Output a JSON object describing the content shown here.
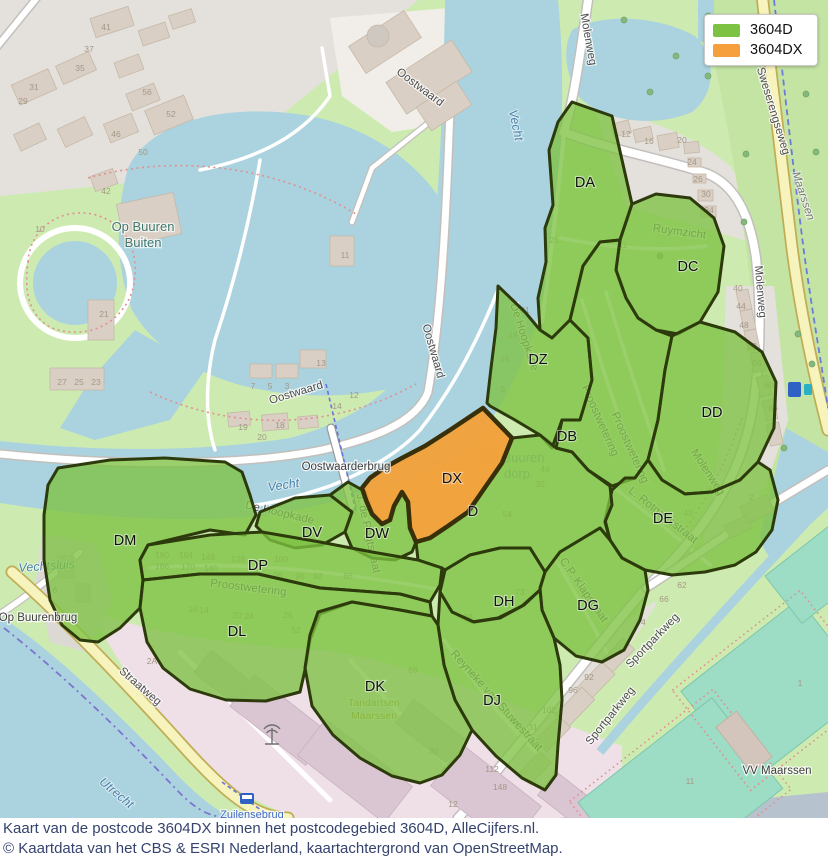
{
  "legend": {
    "items": [
      {
        "label": "3604D",
        "color": "#7dc243"
      },
      {
        "label": "3604DX",
        "color": "#f5a03c"
      }
    ]
  },
  "caption": {
    "line1": "Kaart van de postcode 3604DX binnen het postcodegebied 3604D, AlleCijfers.nl.",
    "line2": "© Kaartdata van het CBS & ESRI Nederland, kaartachtergrond van OpenStreetMap."
  },
  "colors": {
    "region_green": "#7dc243",
    "region_orange": "#f5a03c",
    "region_outline": "#2c3a0c",
    "water": "#aad3df",
    "grass": "#cdebb0",
    "residential": "#e4e1dd",
    "industrial": "#efdfe7",
    "pitch": "#9ddcc5",
    "road_yellow": "#f7f3bc"
  },
  "map": {
    "regions": [
      {
        "code": "DA",
        "x": 585,
        "y": 187
      },
      {
        "code": "DC",
        "x": 688,
        "y": 271
      },
      {
        "code": "DZ",
        "x": 538,
        "y": 364
      },
      {
        "code": "DB",
        "x": 567,
        "y": 441
      },
      {
        "code": "DD",
        "x": 712,
        "y": 417
      },
      {
        "code": "DX",
        "x": 452,
        "y": 483
      },
      {
        "code": "D",
        "x": 473,
        "y": 516
      },
      {
        "code": "DE",
        "x": 663,
        "y": 523
      },
      {
        "code": "DM",
        "x": 125,
        "y": 545
      },
      {
        "code": "DV",
        "x": 312,
        "y": 537
      },
      {
        "code": "DW",
        "x": 377,
        "y": 538
      },
      {
        "code": "DP",
        "x": 258,
        "y": 570
      },
      {
        "code": "DL",
        "x": 237,
        "y": 636
      },
      {
        "code": "DH",
        "x": 504,
        "y": 606
      },
      {
        "code": "DG",
        "x": 588,
        "y": 610
      },
      {
        "code": "DK",
        "x": 375,
        "y": 691
      },
      {
        "code": "DJ",
        "x": 492,
        "y": 705
      }
    ],
    "street_labels": [
      {
        "t": "Oostwaard",
        "x": 418,
        "y": 90,
        "r": 37
      },
      {
        "t": "Oostwaard",
        "x": 430,
        "y": 352,
        "r": 74
      },
      {
        "t": "Oostwaard",
        "x": 297,
        "y": 396,
        "r": -17
      },
      {
        "t": "Molenweg",
        "x": 585,
        "y": 40,
        "r": 80
      },
      {
        "t": "Molenweg",
        "x": 757,
        "y": 292,
        "r": 85
      },
      {
        "t": "Molenweg",
        "x": 705,
        "y": 474,
        "r": 57
      },
      {
        "t": "Sweserengseweg",
        "x": 770,
        "y": 112,
        "r": 73
      },
      {
        "t": "Straatweg",
        "x": 138,
        "y": 689,
        "r": 41
      },
      {
        "t": "Sportparkweg",
        "x": 655,
        "y": 643,
        "r": -46
      },
      {
        "t": "Sportparkweg",
        "x": 613,
        "y": 718,
        "r": -51
      },
      {
        "t": "Proostwetering",
        "x": 597,
        "y": 422,
        "r": 66
      },
      {
        "t": "Proostwetering",
        "x": 627,
        "y": 449,
        "r": 66
      },
      {
        "t": "Proostwetering",
        "x": 248,
        "y": 591,
        "r": 7
      },
      {
        "t": "De Hoopkade",
        "x": 521,
        "y": 338,
        "r": 72
      },
      {
        "t": "De Hoopkade",
        "x": 279,
        "y": 516,
        "r": 13
      },
      {
        "t": "Ruymzicht",
        "x": 679,
        "y": 235,
        "r": 8
      },
      {
        "t": "C.P. Klapstraat",
        "x": 581,
        "y": 592,
        "r": 55
      },
      {
        "t": "L. Rotgansstraat",
        "x": 661,
        "y": 518,
        "r": 38
      },
      {
        "t": "Reyneke van Stuwestraat",
        "x": 494,
        "y": 703,
        "r": 48
      },
      {
        "t": "J. de Regtstraat",
        "x": 365,
        "y": 534,
        "r": 78
      }
    ],
    "water_labels": [
      {
        "t": "Vecht",
        "x": 512,
        "y": 126,
        "r": 78
      },
      {
        "t": "Vecht",
        "x": 284,
        "y": 489,
        "r": -8
      },
      {
        "t": "Utrecht",
        "x": 114,
        "y": 796,
        "r": 40
      },
      {
        "t": "Vechtsluis",
        "x": 47,
        "y": 570,
        "r": -4
      }
    ],
    "place_labels": [
      {
        "t": "Op Buuren",
        "x": 143,
        "y": 231,
        "cls": "pl"
      },
      {
        "t": "Buiten",
        "x": 143,
        "y": 247,
        "cls": "pl"
      },
      {
        "t": "Op Buuren",
        "x": 513,
        "y": 462,
        "cls": "faded"
      },
      {
        "t": "dorp",
        "x": 517,
        "y": 478,
        "cls": "faded"
      },
      {
        "t": "VV Maarssen",
        "x": 777,
        "y": 774,
        "cls": "pl2"
      },
      {
        "t": "Oostwaarderbrug",
        "x": 346,
        "y": 470,
        "cls": "pl2"
      },
      {
        "t": "Op Buurenbrug",
        "x": 38,
        "y": 621,
        "cls": "pl2"
      },
      {
        "t": "Zuilensebrug",
        "x": 252,
        "y": 818,
        "cls": "blue"
      },
      {
        "t": "Maarssen",
        "x": 800,
        "y": 197,
        "cls": "dest",
        "r": 72
      }
    ],
    "poi_labels": [
      {
        "t": "Tandartsen",
        "x": 374,
        "y": 706
      },
      {
        "t": "Maarssen",
        "x": 374,
        "y": 719
      }
    ],
    "icons": [
      {
        "name": "parking-icon",
        "glyph": "P",
        "x": 630,
        "y": 194,
        "color": "#2f62c4",
        "size": 13
      },
      {
        "name": "parking-icon",
        "glyph": "P",
        "x": 769,
        "y": 258,
        "color": "#2f62c4",
        "size": 13
      },
      {
        "name": "swimming-waves-icon",
        "glyph": "≈",
        "x": 433,
        "y": 606,
        "color": "#3fa3c4",
        "size": 15
      },
      {
        "name": "swimming-waves-icon",
        "glyph": "≈",
        "x": 433,
        "y": 614,
        "color": "#3fa3c4",
        "size": 15
      },
      {
        "name": "dentist-cross-icon",
        "glyph": "+",
        "x": 372,
        "y": 665,
        "color": "#bb8d33",
        "size": 18
      },
      {
        "name": "dentist-cross-icon",
        "glyph": "+",
        "x": 340,
        "y": 637,
        "color": "#bb8d33",
        "size": 12
      },
      {
        "name": "ev-charging-icon",
        "glyph": "ϟ",
        "x": 795,
        "y": 393,
        "color": "#ffffff",
        "size": 11
      },
      {
        "name": "bus-stop-icon",
        "glyph": "■",
        "x": 247,
        "y": 804,
        "color": "#2f62c4",
        "size": 11
      }
    ],
    "house_numbers": [
      {
        "t": "41",
        "x": 106,
        "y": 30
      },
      {
        "t": "37",
        "x": 89,
        "y": 52
      },
      {
        "t": "35",
        "x": 80,
        "y": 71
      },
      {
        "t": "31",
        "x": 34,
        "y": 90
      },
      {
        "t": "29",
        "x": 23,
        "y": 104
      },
      {
        "t": "56",
        "x": 147,
        "y": 95
      },
      {
        "t": "52",
        "x": 171,
        "y": 117
      },
      {
        "t": "46",
        "x": 116,
        "y": 137
      },
      {
        "t": "50",
        "x": 143,
        "y": 155
      },
      {
        "t": "42",
        "x": 106,
        "y": 194
      },
      {
        "t": "10",
        "x": 40,
        "y": 232
      },
      {
        "t": "21",
        "x": 104,
        "y": 317
      },
      {
        "t": "27",
        "x": 62,
        "y": 385
      },
      {
        "t": "25",
        "x": 79,
        "y": 385
      },
      {
        "t": "23",
        "x": 96,
        "y": 385
      },
      {
        "t": "13",
        "x": 321,
        "y": 366
      },
      {
        "t": "11",
        "x": 345,
        "y": 258
      },
      {
        "t": "7",
        "x": 253,
        "y": 389
      },
      {
        "t": "5",
        "x": 270,
        "y": 389
      },
      {
        "t": "3",
        "x": 287,
        "y": 389
      },
      {
        "t": "19",
        "x": 243,
        "y": 430
      },
      {
        "t": "18",
        "x": 280,
        "y": 428
      },
      {
        "t": "20",
        "x": 262,
        "y": 440
      },
      {
        "t": "14",
        "x": 337,
        "y": 409
      },
      {
        "t": "12",
        "x": 354,
        "y": 398
      },
      {
        "t": "12",
        "x": 626,
        "y": 137
      },
      {
        "t": "16",
        "x": 649,
        "y": 144
      },
      {
        "t": "20",
        "x": 682,
        "y": 143
      },
      {
        "t": "24",
        "x": 692,
        "y": 165
      },
      {
        "t": "26",
        "x": 698,
        "y": 182
      },
      {
        "t": "30",
        "x": 706,
        "y": 197
      },
      {
        "t": "34",
        "x": 709,
        "y": 213
      },
      {
        "t": "11",
        "x": 623,
        "y": 248
      },
      {
        "t": "25",
        "x": 554,
        "y": 243
      },
      {
        "t": "40",
        "x": 738,
        "y": 291
      },
      {
        "t": "44",
        "x": 741,
        "y": 309
      },
      {
        "t": "48",
        "x": 744,
        "y": 328
      },
      {
        "t": "52",
        "x": 752,
        "y": 349
      },
      {
        "t": "56",
        "x": 757,
        "y": 366
      },
      {
        "t": "60",
        "x": 769,
        "y": 388
      },
      {
        "t": "66",
        "x": 773,
        "y": 411
      },
      {
        "t": "2",
        "x": 751,
        "y": 500
      },
      {
        "t": "180",
        "x": 162,
        "y": 558
      },
      {
        "t": "164",
        "x": 186,
        "y": 558
      },
      {
        "t": "148",
        "x": 208,
        "y": 560
      },
      {
        "t": "186",
        "x": 162,
        "y": 569
      },
      {
        "t": "170",
        "x": 188,
        "y": 570
      },
      {
        "t": "140",
        "x": 211,
        "y": 571
      },
      {
        "t": "138",
        "x": 238,
        "y": 562
      },
      {
        "t": "100",
        "x": 281,
        "y": 562
      },
      {
        "t": "98",
        "x": 278,
        "y": 578
      },
      {
        "t": "96",
        "x": 300,
        "y": 579
      },
      {
        "t": "92",
        "x": 318,
        "y": 579
      },
      {
        "t": "86",
        "x": 348,
        "y": 579
      },
      {
        "t": "10",
        "x": 193,
        "y": 612
      },
      {
        "t": "14",
        "x": 204,
        "y": 613
      },
      {
        "t": "20",
        "x": 237,
        "y": 618
      },
      {
        "t": "24",
        "x": 249,
        "y": 619
      },
      {
        "t": "26",
        "x": 288,
        "y": 618
      },
      {
        "t": "52",
        "x": 296,
        "y": 633
      },
      {
        "t": "62",
        "x": 682,
        "y": 588
      },
      {
        "t": "66",
        "x": 664,
        "y": 602
      },
      {
        "t": "74",
        "x": 641,
        "y": 625
      },
      {
        "t": "92",
        "x": 589,
        "y": 680
      },
      {
        "t": "96",
        "x": 573,
        "y": 693
      },
      {
        "t": "102",
        "x": 549,
        "y": 713
      },
      {
        "t": "112",
        "x": 492,
        "y": 772
      },
      {
        "t": "148",
        "x": 500,
        "y": 790
      },
      {
        "t": "36",
        "x": 434,
        "y": 754
      },
      {
        "t": "12",
        "x": 453,
        "y": 807
      },
      {
        "t": "2A",
        "x": 152,
        "y": 664
      },
      {
        "t": "68",
        "x": 413,
        "y": 673
      },
      {
        "t": "6",
        "x": 55,
        "y": 593
      },
      {
        "t": "19",
        "x": 513,
        "y": 338
      },
      {
        "t": "15",
        "x": 505,
        "y": 362
      },
      {
        "t": "5",
        "x": 503,
        "y": 392
      },
      {
        "t": "31",
        "x": 525,
        "y": 313
      },
      {
        "t": "43",
        "x": 688,
        "y": 516
      },
      {
        "t": "31",
        "x": 533,
        "y": 730
      },
      {
        "t": "89",
        "x": 468,
        "y": 620
      },
      {
        "t": "73",
        "x": 520,
        "y": 595
      },
      {
        "t": "34",
        "x": 436,
        "y": 464
      },
      {
        "t": "48",
        "x": 447,
        "y": 483
      },
      {
        "t": "46",
        "x": 545,
        "y": 472
      },
      {
        "t": "30",
        "x": 540,
        "y": 487
      },
      {
        "t": "54",
        "x": 507,
        "y": 517
      },
      {
        "t": "1",
        "x": 800,
        "y": 686
      },
      {
        "t": "11",
        "x": 690,
        "y": 784
      }
    ]
  }
}
